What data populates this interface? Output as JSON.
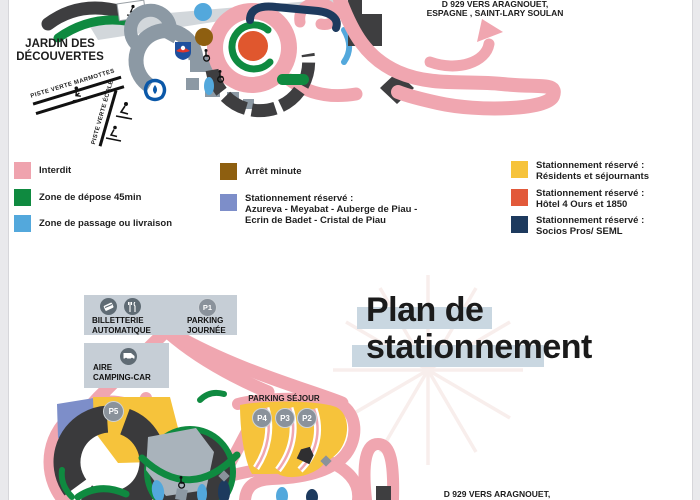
{
  "top_map": {
    "jardin": {
      "line1": "JARDIN DES",
      "line2": "DÉCOUVERTES"
    },
    "piste_marmottes": "PISTE VERTE MARMOTTES",
    "piste_ecole": "PISTE VERTE ÉCOLE",
    "road_top": {
      "line1": "D 929 VERS ARAGNOUET,",
      "line2": "ESPAGNE , SAINT-LARY SOULAN"
    }
  },
  "legend": {
    "items": [
      {
        "color": "#efa3ae",
        "lines": [
          "Interdit"
        ]
      },
      {
        "color": "#0f8a40",
        "lines": [
          "Zone de dépose 45min"
        ]
      },
      {
        "color": "#53a8dc",
        "lines": [
          "Zone de passage ou livraison"
        ]
      },
      {
        "color": "#8e5f10",
        "lines": [
          "Arrêt minute"
        ]
      },
      {
        "color": "#7d8ec9",
        "lines": [
          "Stationnement réservé :",
          "Azureva - Meyabat - Auberge de Piau -",
          "Ecrin de Badet - Cristal de Piau"
        ]
      },
      {
        "color": "#f6c33b",
        "lines": [
          "Stationnement réservé :",
          "Résidents et séjournants"
        ]
      },
      {
        "color": "#e2593a",
        "lines": [
          "Stationnement réservé :",
          "Hôtel 4 Ours et 1850"
        ]
      },
      {
        "color": "#1d3a5e",
        "lines": [
          "Stationnement réservé :",
          "Socios Pros/ SEML"
        ]
      }
    ]
  },
  "bottom_map": {
    "title": {
      "line1": "Plan de",
      "line2": "stationnement"
    },
    "billetterie": {
      "line1": "BILLETTERIE",
      "line2": "AUTOMATIQUE"
    },
    "parking_journee": {
      "line1": "PARKING",
      "line2": "JOURNÉE"
    },
    "aire_camping": {
      "line1": "AIRE",
      "line2": "CAMPING-CAR"
    },
    "parking_sejour": "PARKING SÉJOUR",
    "markers": {
      "p1": "P1",
      "p2": "P2",
      "p3": "P3",
      "p4": "P4",
      "p5": "P5"
    },
    "road_bottom": "D 929 VERS ARAGNOUET,"
  },
  "colors": {
    "pink_road": "#f0a6b0",
    "dark_building": "#3e3e40",
    "gray_road": "#8c99a4",
    "label_box": "#c6ced6",
    "title_highlight": "#c9d7e1"
  }
}
